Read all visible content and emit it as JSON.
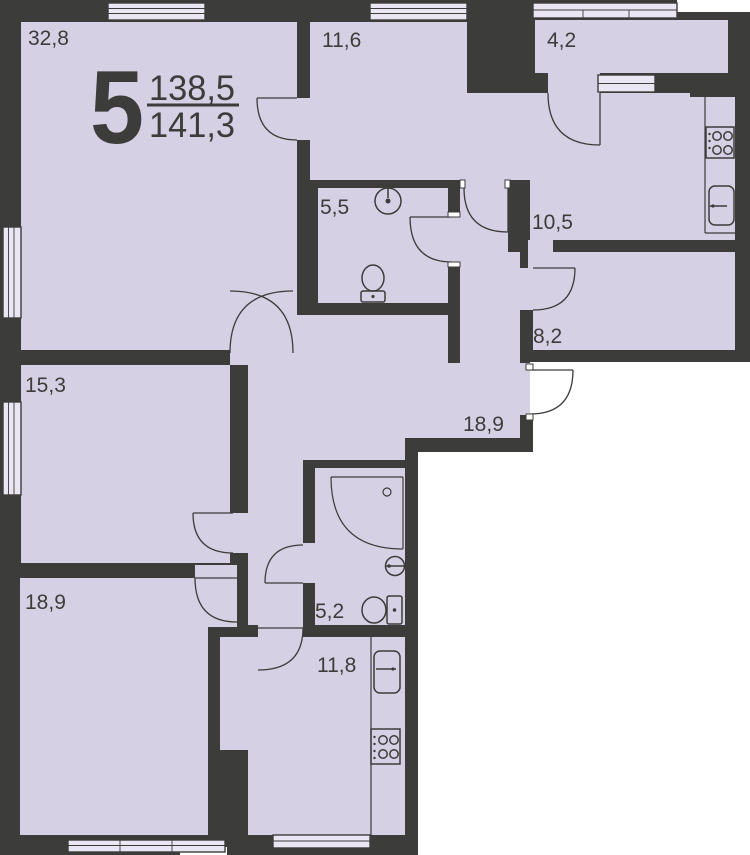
{
  "plan": {
    "apartment": {
      "number": "5",
      "area_upper": "138,5",
      "area_lower": "141,3"
    },
    "rooms": [
      {
        "name": "living-room",
        "area": "32,8"
      },
      {
        "name": "bedroom-top",
        "area": "11,6"
      },
      {
        "name": "loggia",
        "area": "4,2"
      },
      {
        "name": "bathroom-wc",
        "area": "5,5"
      },
      {
        "name": "kitchen",
        "area": "10,5"
      },
      {
        "name": "hall",
        "area": "8,2"
      },
      {
        "name": "bedroom-middle",
        "area": "15,3"
      },
      {
        "name": "corridor",
        "area": "18,9"
      },
      {
        "name": "shower-room",
        "area": "5,2"
      },
      {
        "name": "bedroom-bottom",
        "area": "18,9"
      },
      {
        "name": "kitchen-dining",
        "area": "11,8"
      }
    ],
    "fixtures": [
      "round-sink",
      "toilet",
      "stove-4-burner",
      "kitchen-sink",
      "corner-shower",
      "wall-sink",
      "toilet",
      "kitchen-sink",
      "stove-4-burner"
    ],
    "colors": {
      "wall": "#3c3c3a",
      "floor": "#d6d0e4",
      "outside": "#ffffff",
      "window_glass": "#eae6f4"
    }
  }
}
